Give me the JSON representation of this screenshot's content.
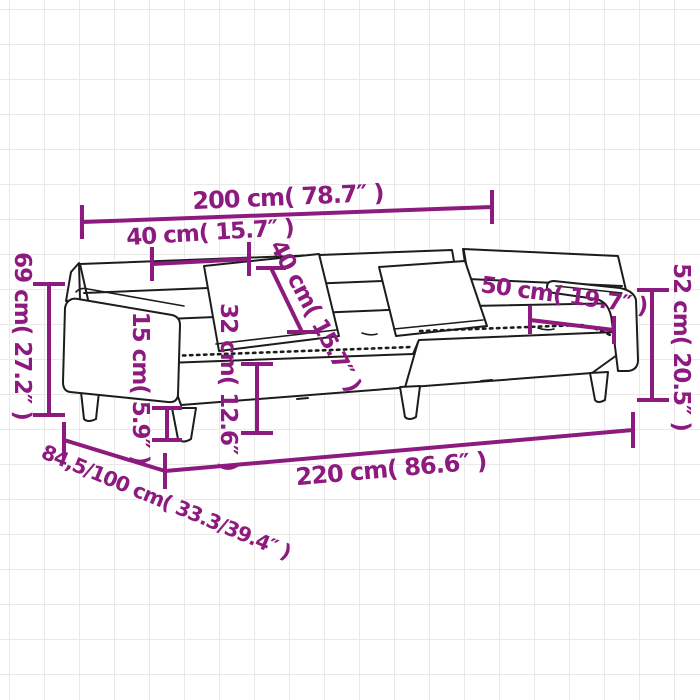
{
  "page": {
    "colors": {
      "background": "#ffffff",
      "grid_line": "#e9e9e9",
      "accent": "#8d1a7e",
      "drawing_line": "#1c1c1c"
    }
  },
  "diagram": {
    "subject": "2-seater sofa bed with two pillows - dimension drawing",
    "units": [
      "cm",
      "inch"
    ],
    "measurements": {
      "back_width": {
        "label": "200 cm( 78.7″ )",
        "cm": "200",
        "inch": "78.7"
      },
      "back_cushion_width": {
        "label": "40 cm( 15.7″ )",
        "cm": "40",
        "inch": "15.7"
      },
      "back_cushion_height": {
        "label": "40 cm( 15.7″ )",
        "cm": "40",
        "inch": "15.7"
      },
      "total_height": {
        "label": "69 cm( 27.2″ )",
        "cm": "69",
        "inch": "27.2"
      },
      "leg_height": {
        "label": "15 cm( 5.9″ )",
        "cm": "15",
        "inch": "5.9"
      },
      "seat_height": {
        "label": "32 cm( 12.6″ )",
        "cm": "32",
        "inch": "12.6"
      },
      "armrest_length": {
        "label": "50 cm( 19.7″ )",
        "cm": "50",
        "inch": "19.7"
      },
      "armrest_height": {
        "label": "52 cm( 20.5″ )",
        "cm": "52",
        "inch": "20.5"
      },
      "total_width": {
        "label": "220 cm( 86.6″ )",
        "cm": "220",
        "inch": "86.6"
      },
      "depth": {
        "label": "84,5/100 cm( 33.3/39.4″ )",
        "cm": "84,5/100",
        "inch": "33.3/39.4"
      }
    }
  }
}
